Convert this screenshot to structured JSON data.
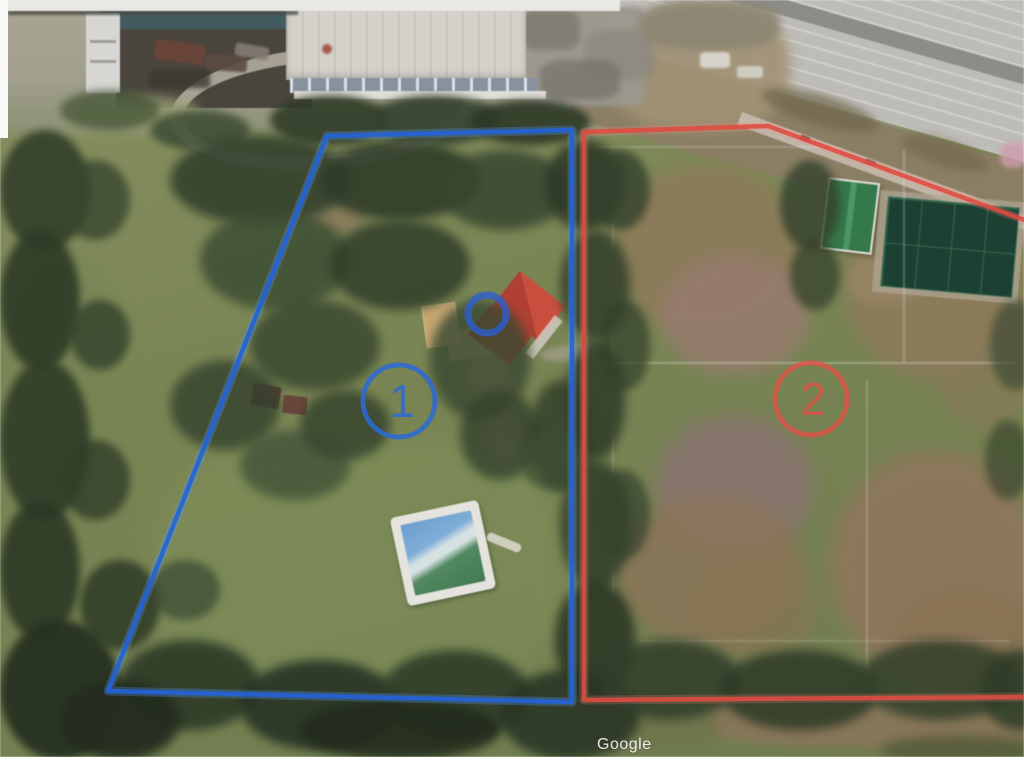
{
  "view": {
    "type": "satellite-aerial-photo",
    "provider_watermark": "Google"
  },
  "annotations": {
    "parcels": [
      {
        "label": "1",
        "outline_color": "#2463d8",
        "outline_style": "blue polygon"
      },
      {
        "label": "2",
        "outline_color": "#e04b41",
        "outline_style": "red polygon"
      }
    ],
    "house_marker": {
      "shape": "circle",
      "color": "#2a5fd2"
    }
  }
}
